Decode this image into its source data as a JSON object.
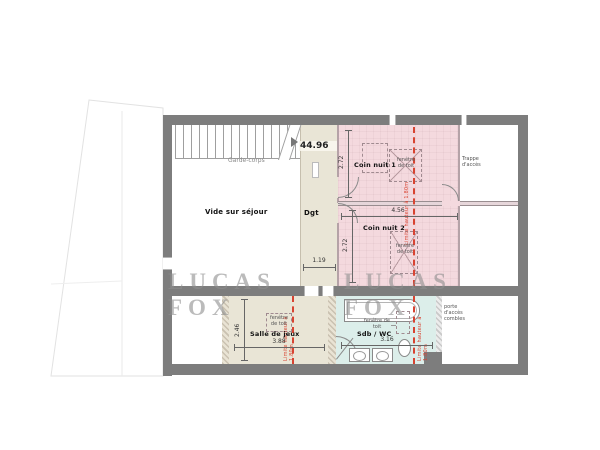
{
  "drawing": {
    "area_value": "44.96",
    "watermark": "LUCAS FOX",
    "rooms": {
      "vide_sejour": "Vide sur séjour",
      "degagement": "Dgt",
      "coin_nuit_1": "Coin nuit 1",
      "coin_nuit_2": "Coin nuit 2",
      "salle_de_jeux": "Salle de jeux",
      "sdb_wc": "Sdb / WC"
    },
    "annotations": {
      "garde_corps": "Garde-corps",
      "trappe_acces": "Trappe d'accès",
      "porte_acces_combles": "porte d'accès combles",
      "fenetre_de_toit": "fenêtre de toit",
      "limite_hauteur": "Limite hauteur à 1.80m"
    },
    "dimensions": {
      "coin1_depth": "2.72",
      "coin_width": "4.56",
      "coin2_depth": "2.72",
      "dgt_width": "1.19",
      "salle_width": "3.88",
      "salle_depth": "2.46",
      "sdb_width": "3.16"
    },
    "colors": {
      "wall": "#7d7d7d",
      "bedroom_fill": "#f4d9de",
      "corridor_fill": "#e9e5d6",
      "bathroom_fill": "#dceeea",
      "limit_line": "#d84331"
    }
  }
}
